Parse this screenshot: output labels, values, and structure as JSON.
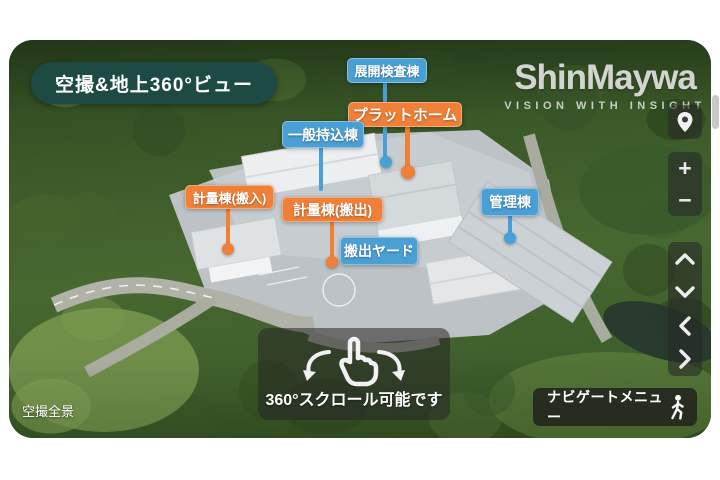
{
  "viewer": {
    "view_badge": "空撮&地上360°ビュー",
    "corner_caption": "空撮全景",
    "gesture_hint": "360°スクロール可能です",
    "navigate_menu_label": "ナビゲートメニュー"
  },
  "logo": {
    "wordmark": "ShinMaywa",
    "tagline": "VISION WITH INSIGHT"
  },
  "labels": [
    {
      "text": "展開検査棟",
      "color": "blue"
    },
    {
      "text": "プラットホーム",
      "color": "orange"
    },
    {
      "text": "一般持込棟",
      "color": "blue"
    },
    {
      "text": "計量棟(搬入)",
      "color": "orange"
    },
    {
      "text": "計量棟(搬出)",
      "color": "orange"
    },
    {
      "text": "搬出ヤード",
      "color": "blue"
    },
    {
      "text": "管理棟",
      "color": "blue"
    }
  ],
  "controls": {
    "zoom_in": "+",
    "zoom_out": "−",
    "icons": [
      "map-pin-icon",
      "chevron-up-icon",
      "chevron-down-icon",
      "chevron-left-icon",
      "chevron-right-icon",
      "rotate-hand-icon",
      "walking-person-icon"
    ]
  },
  "colors": {
    "label_blue": "#4aa0d5",
    "label_orange": "#f08038",
    "badge_green": "#1d4b43",
    "overlay_dark": "rgba(40,40,40,0.58)"
  }
}
